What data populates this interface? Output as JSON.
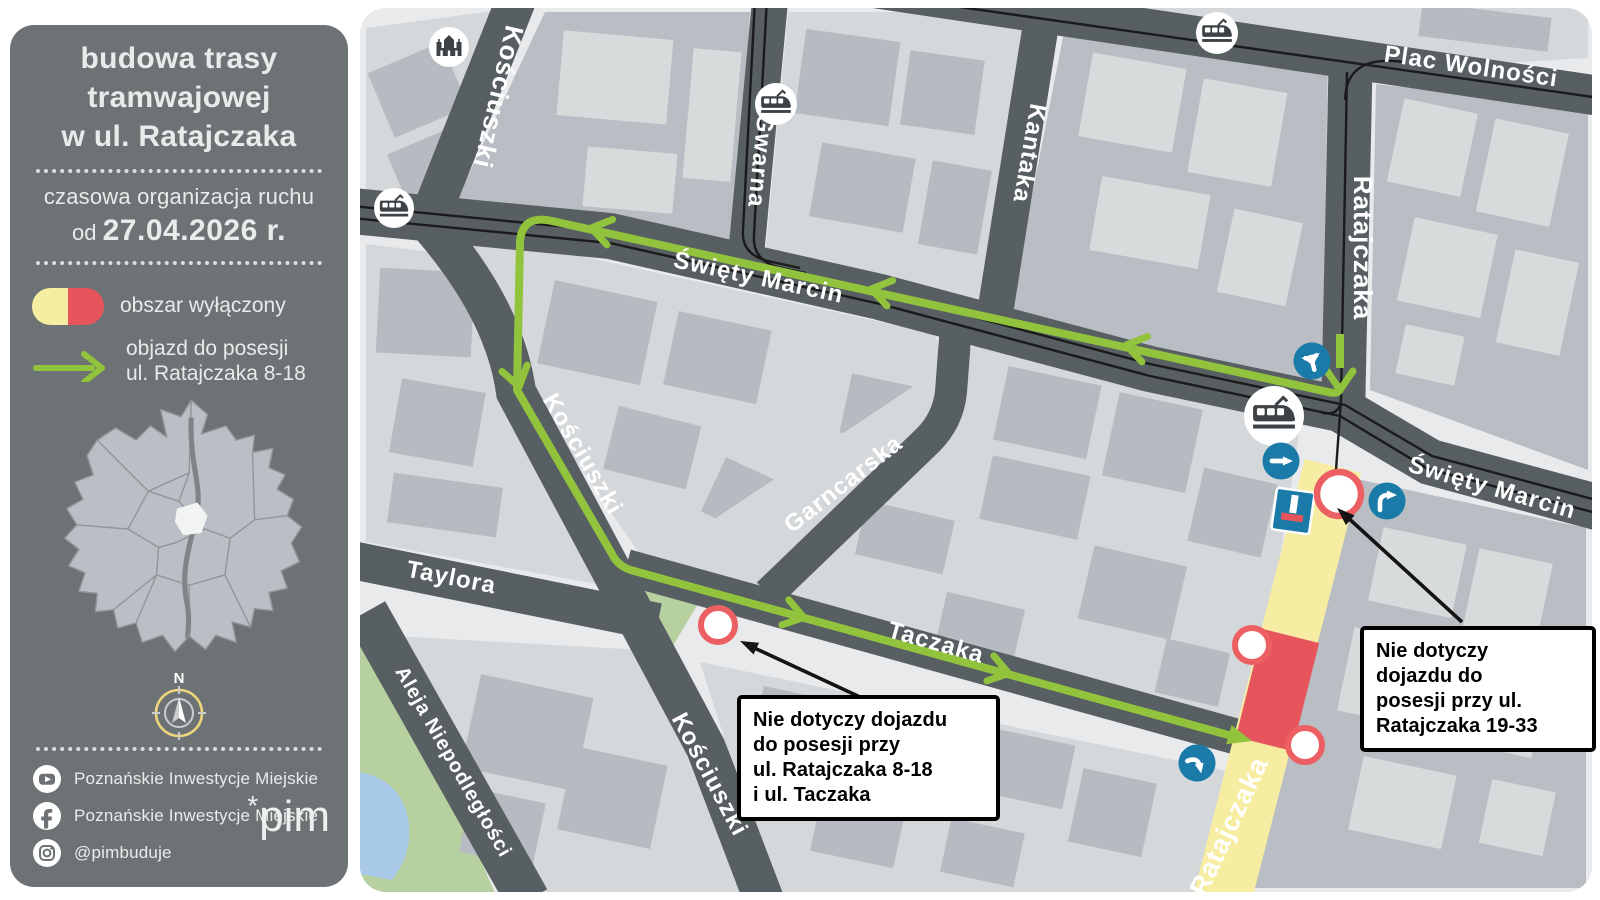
{
  "sidebar": {
    "background": "#6d7375",
    "title_lines": [
      "budowa trasy",
      "tramwajowej",
      "w ul. Ratajczaka"
    ],
    "subtitle": "czasowa organizacja ruchu",
    "date_prefix": "od",
    "date": "27.04.2026 r.",
    "legend": {
      "excluded_area_label": "obszar wyłączony",
      "excluded_colors": [
        "#f7eda2",
        "#e6555c"
      ],
      "detour_label_lines": [
        "objazd do posesji",
        "ul. Ratajczaka 8-18"
      ],
      "detour_color": "#92c33d"
    },
    "compass_label": "N",
    "social_rows": [
      {
        "icon": "youtube-icon",
        "label": "Poznańskie Inwestycje Miejskie"
      },
      {
        "icon": "facebook-icon",
        "label": "Poznańskie Inwestycje Miejskie"
      },
      {
        "icon": "instagram-icon",
        "label": "@pimbuduje"
      }
    ],
    "logo_mark": "*",
    "logo_text": "pim"
  },
  "map": {
    "street_labels": [
      {
        "id": "kosciuszki-north",
        "name": "Kościuszki"
      },
      {
        "id": "gwarna",
        "name": "Gwarna"
      },
      {
        "id": "kantaka",
        "name": "Kantaka"
      },
      {
        "id": "ratajczaka-north",
        "name": "Ratajczaka"
      },
      {
        "id": "plac-wolnosci",
        "name": "Plac Wolności"
      },
      {
        "id": "swiety-marcin-west",
        "name": "Święty Marcin"
      },
      {
        "id": "swiety-marcin-east",
        "name": "Święty Marcin"
      },
      {
        "id": "kosciuszki-mid",
        "name": "Kościuszki"
      },
      {
        "id": "kosciuszki-south",
        "name": "Kościuszki"
      },
      {
        "id": "garncarska",
        "name": "Garncarska"
      },
      {
        "id": "taylora",
        "name": "Taylora"
      },
      {
        "id": "taczaka",
        "name": "Taczaka"
      },
      {
        "id": "aleja-niepodleglosci",
        "name": "Aleja Niepodległości"
      },
      {
        "id": "ratajczaka-south",
        "name": "Ratajczaka"
      }
    ],
    "callouts": [
      {
        "id": "note-ratajczaka-8-18",
        "lines": [
          "Nie dotyczy dojazdu",
          "do posesji przy",
          "ul. Ratajczaka 8-18",
          "i ul. Taczaka"
        ]
      },
      {
        "id": "note-ratajczaka-19-33",
        "lines": [
          "Nie dotyczy",
          "dojazdu do",
          "posesji przy ul.",
          "Ratajczaka 19-33"
        ]
      }
    ],
    "colors": {
      "road": "#575f62",
      "background": "#e9eaeb",
      "block_light": "#d5d8da",
      "building_dark": "#b5bbc0",
      "park_green": "#b7d0a0",
      "water_blue": "#a9c9e9",
      "detour_green": "#92c33d",
      "closed_yellow": "#f7eda2",
      "closed_red": "#e6555c",
      "sign_blue": "#1a7aa8",
      "closure_ring": "#ec5f63",
      "tram_track": "#1b1b1b"
    }
  }
}
